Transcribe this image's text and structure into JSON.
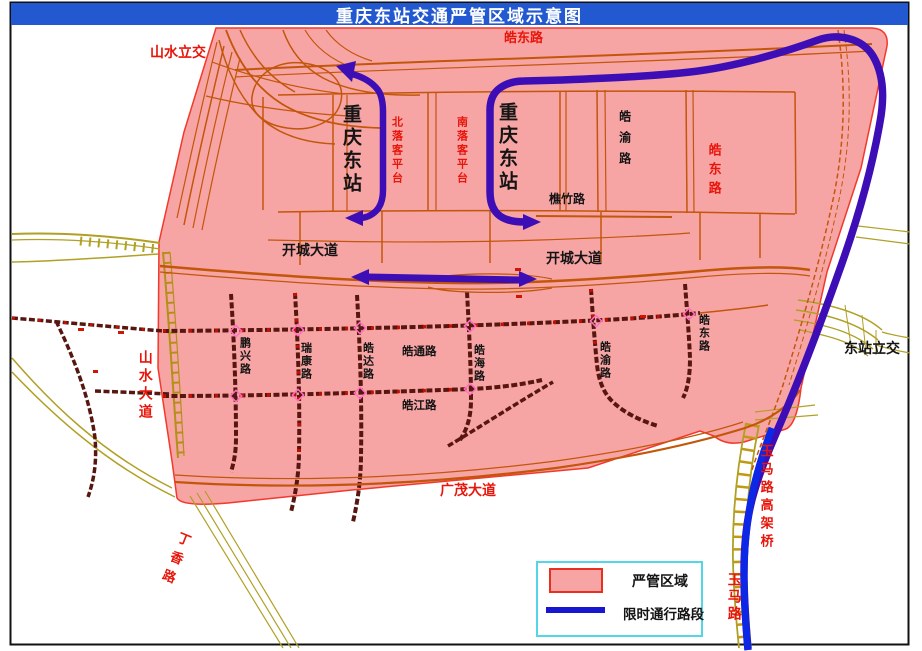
{
  "title": "重庆东站交通严管区域示意图",
  "legend": {
    "zone_label": "严管区域",
    "route_label": "限时通行路段"
  },
  "labels": {
    "shanshui_lijiao": "山水立交",
    "haodong_top": "皓东路",
    "station_west": "重庆东站",
    "station_east": "重庆东站",
    "north_platform": "北落客平台",
    "south_platform": "南落客平台",
    "haoyu_upper": "皓渝路",
    "haodong_right": "皓东路",
    "qiaozhu": "樵竹路",
    "kaicheng_west": "开城大道",
    "kaicheng_east": "开城大道",
    "dongzhan_lijiao": "东站立交",
    "shanshui_avenue": "山水大道",
    "pengxing": "鹏兴路",
    "ruikang": "瑞康路",
    "haoda": "皓达路",
    "haotong": "皓通路",
    "haohai": "皓海路",
    "haoyu_lower": "皓渝路",
    "haodong_lower": "皓东路",
    "haojiang": "皓江路",
    "guangmao": "广茂大道",
    "dingxiang": "丁香路",
    "yuma_viaduct": "玉马路高架桥",
    "yuma_road": "玉马路"
  },
  "colors": {
    "title_bar": "#2359D0",
    "zone_fill": "#F7A4A4",
    "zone_border": "#F2392C",
    "route_blue_dark": "#3D0EB5",
    "route_blue_bright": "#0C27E6",
    "legend_line_blue": "#1717CF",
    "road_orange": "#C2560A",
    "road_olive": "#B0A024",
    "road_dark": "#571610",
    "label_red": "#E8150A",
    "legend_border": "#55D6E8"
  }
}
